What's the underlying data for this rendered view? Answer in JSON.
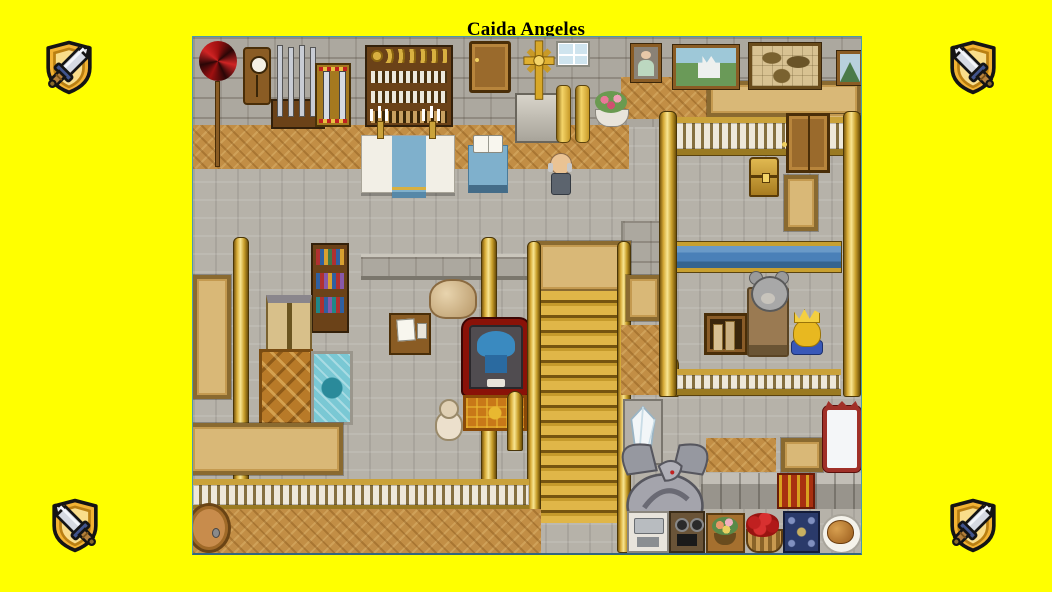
{
  "page": {
    "title": "Caida Angeles",
    "background_color": "#ffff00",
    "title_color": "#000000"
  },
  "map": {
    "border_color": "#4a9aa8"
  },
  "icons": {
    "corner_icon_name": "sword-shield-icon",
    "positions": [
      "top-left",
      "top-right",
      "bottom-left",
      "bottom-right"
    ],
    "shield_gold": "#f2b233",
    "shield_inner": "#f9dd8a",
    "blade_silver": "#d6dae2",
    "guard_blue": "#41548c",
    "grip_brown": "#b4803c"
  }
}
